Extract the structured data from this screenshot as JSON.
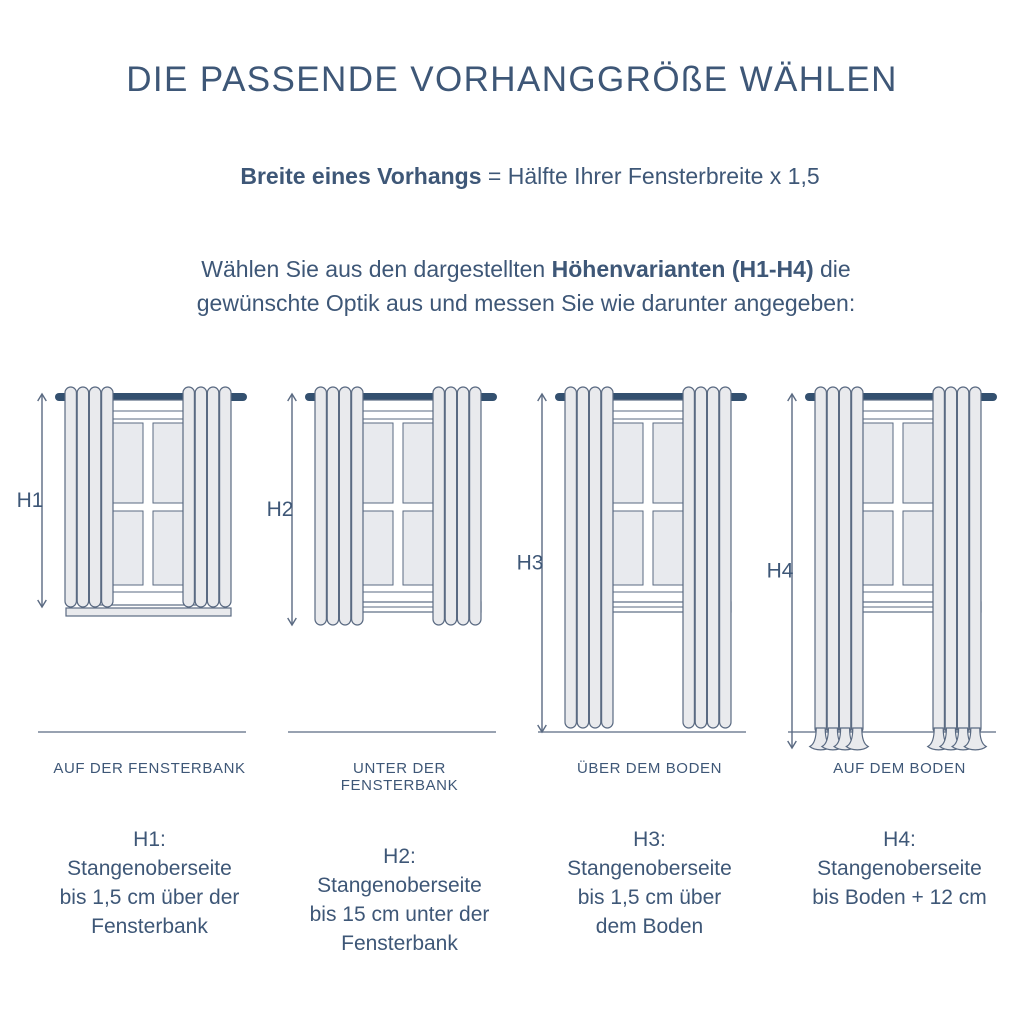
{
  "title": "DIE PASSENDE VORHANGGRÖßE WÄHLEN",
  "formula": {
    "bold": "Breite eines Vorhangs",
    "rest": "= Hälfte Ihrer Fensterbreite x 1,5"
  },
  "instruction": {
    "line1_pre": "Wählen Sie aus den dargestellten",
    "line1_bold": "Höhenvarianten (H1-H4)",
    "line1_post": "die",
    "line2": "gewünschte Optik aus und messen Sie wie darunter angegeben:"
  },
  "colors": {
    "text_navy": "#3e5777",
    "rod_navy": "#33506f",
    "outline": "#5a6a82",
    "curtain_fill": "#e9eaed",
    "pane_fill": "#e8eaee",
    "window_fill": "#ffffff"
  },
  "variants": [
    {
      "id": "H1",
      "position_label": "AUF DER FENSTERBANK",
      "description": "H1:\nStangenoberseite\nbis 1,5 cm über der\nFensterbank"
    },
    {
      "id": "H2",
      "position_label": "UNTER DER FENSTERBANK",
      "description": "H2:\nStangenoberseite\nbis 15 cm unter der\nFensterbank"
    },
    {
      "id": "H3",
      "position_label": "ÜBER DEM BODEN",
      "description": "H3:\nStangenoberseite\nbis 1,5 cm über\ndem Boden"
    },
    {
      "id": "H4",
      "position_label": "AUF DEM BODEN",
      "description": "H4:\nStangenoberseite\nbis Boden + 12 cm"
    }
  ]
}
